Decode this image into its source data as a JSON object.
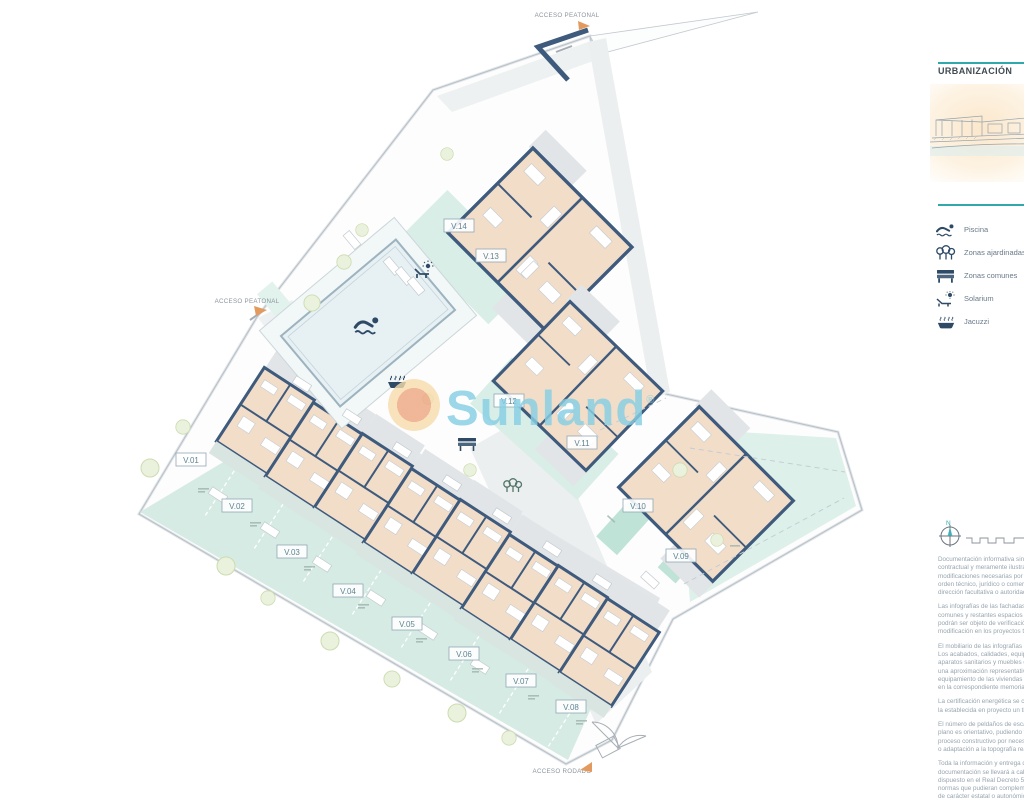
{
  "plan": {
    "watermark": "Sunland",
    "access": {
      "top": "ACCESO PEATONAL",
      "left": "ACCESO PEATONAL",
      "bottom": "ACCESO RODADO"
    },
    "villas": [
      {
        "label": "V.01"
      },
      {
        "label": "V.02"
      },
      {
        "label": "V.03"
      },
      {
        "label": "V.04"
      },
      {
        "label": "V.05"
      },
      {
        "label": "V.06"
      },
      {
        "label": "V.07"
      },
      {
        "label": "V.08"
      },
      {
        "label": "V.09"
      },
      {
        "label": "V.10"
      },
      {
        "label": "V.11"
      },
      {
        "label": "V.12"
      },
      {
        "label": "V.13"
      },
      {
        "label": "V.14"
      }
    ]
  },
  "sidebar": {
    "title": "URBANIZACIÓN",
    "legend": [
      {
        "icon": "swimmer-icon",
        "label": "Piscina"
      },
      {
        "icon": "trees-icon",
        "label": "Zonas ajardinadas"
      },
      {
        "icon": "bench-icon",
        "label": "Zonas comunes"
      },
      {
        "icon": "solarium-icon",
        "label": "Solarium"
      },
      {
        "icon": "jacuzzi-icon",
        "label": "Jacuzzi"
      }
    ],
    "compass_label": "N",
    "disclaimer": [
      "Documentación informativa sin carácter contractual y meramente ilustrativa, sujeta a modificaciones necesarias por exigencias de orden técnico, jurídico o comercial de la dirección facultativa o autoridad competente.",
      "Las infografías de las fachadas, elementos comunes y restantes espacios orientativas y podrán ser objeto de verificación o modificación en los proyectos técnicos.",
      "El mobiliario de las infografías no está incluido. Los acabados, calidades, equipamiento, aparatos sanitarios y muebles de cocina son una aproximación representativa y el equipamiento de las viviendas será el indicado en la correspondiente memoria de calidades.",
      "La certificación energética se corresponde con la establecida en proyecto un tipo.",
      "El número de peldaños de escaleras en este plano es orientativo, pudiendo variar durante el proceso constructivo por necesidades técnicas o adaptación a la topografía real de la parcela.",
      "Toda la información y entrega de documentación se llevará a cabo conforme a lo dispuesto en el Real Decreto 515 y demás normas que pudieran complementarlo, ya sean de carácter estatal o autonómico."
    ]
  },
  "colors": {
    "accent_teal": "#2fa9ac",
    "wall_navy": "#3e5a7c",
    "floor_beige": "#f2ddc9",
    "garden_teal": "#d5ebe3",
    "watermark_blue": "#86cfe4",
    "watermark_orange": "#eda57f"
  }
}
